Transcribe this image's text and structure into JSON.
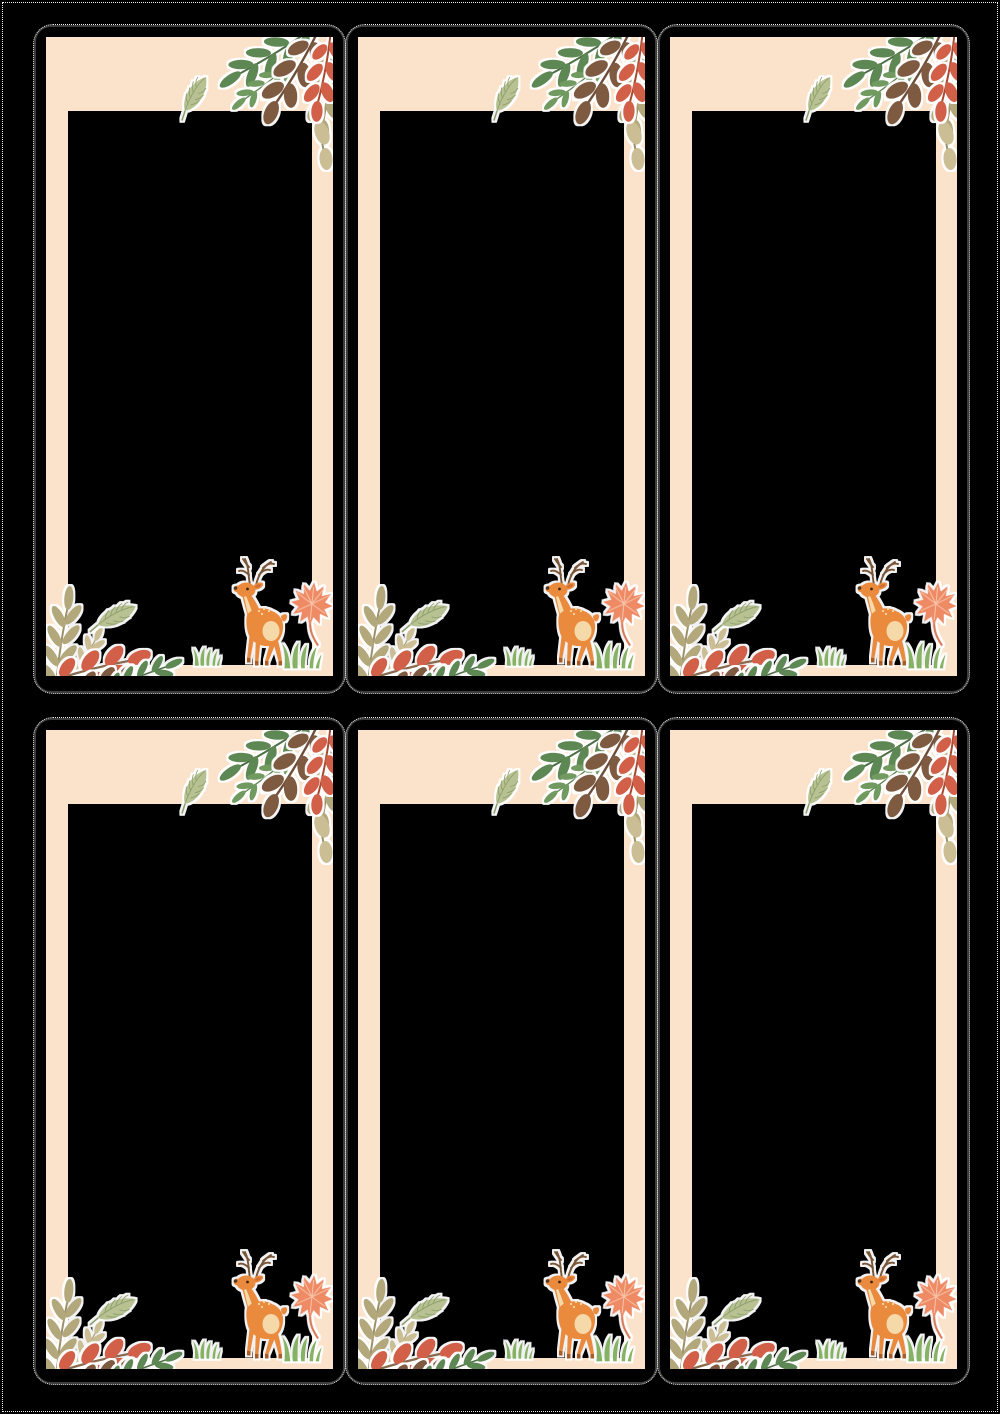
{
  "page": {
    "background": "#000000",
    "cut_line_style": "white-dotted",
    "orientation": "portrait-a4-like"
  },
  "sheet": {
    "rows": 2,
    "columns": 3,
    "card_count": 6,
    "cards_identical": true
  },
  "card": {
    "background": "#fbe3cb",
    "outline_color": "#3d3d3d",
    "cut_dash_color": "#f0f0f0",
    "photo_window_color": "#000000",
    "corner_style": "rounded-outline-square-fill",
    "artwork": [
      "green-branch-top-right",
      "brown-branch-top-right",
      "olive-branch-top-right",
      "red-leaves-top-right",
      "pale-veined-leaf-top",
      "photo-window",
      "olive-branch-bottom-left",
      "red-branch-bottom-left",
      "brown-branch-bottom-left",
      "green-sprig-bottom-left",
      "pale-veined-leaf-bottom",
      "deer",
      "maple-leaf",
      "grass-tuft-small",
      "grass-tuft-large"
    ]
  },
  "palette": {
    "page-bg": "#000000",
    "card-bg": "#fbe3cb",
    "card-outline": "#3d3d3d",
    "cut-dash": "#f0f0f0",
    "window": "#000000",
    "leaf-green-dark": "#5d8752",
    "leaf-green-mid": "#6f9a60",
    "leaf-brown": "#7d5a41",
    "leaf-olive": "#b3a87c",
    "leaf-tan": "#cbbe94",
    "leaf-red": "#d2604a",
    "leaf-pale": "#b7c192",
    "deer-orange": "#ea8a3e",
    "deer-cream": "#f6d9a8",
    "antler-brown": "#7a5636",
    "hoof-brown": "#a85c28",
    "maple-coral": "#ee8b65",
    "maple-vein": "#f8c3a8",
    "grass-green": "#86b364"
  }
}
